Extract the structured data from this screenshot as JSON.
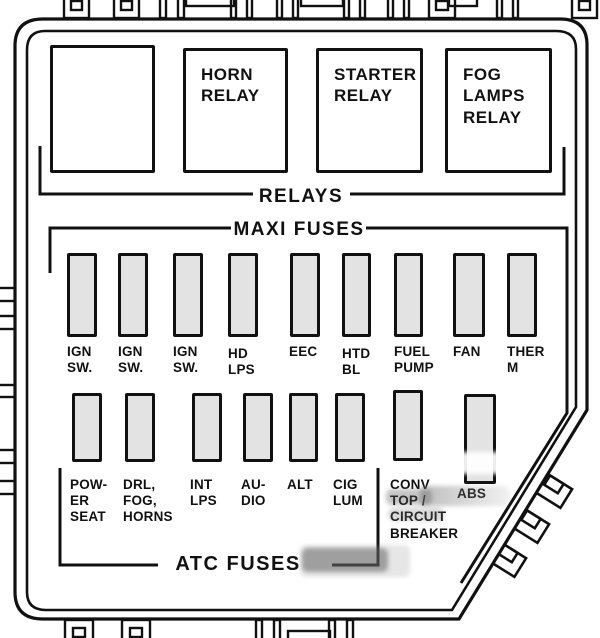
{
  "sections": {
    "relays": {
      "label": "RELAYS",
      "boxes": [
        {
          "label": ""
        },
        {
          "label": "HORN\nRELAY"
        },
        {
          "label": "STARTER\nRELAY"
        },
        {
          "label": "FOG\nLAMPS\nRELAY"
        }
      ]
    },
    "maxi_fuses": {
      "label": "MAXI FUSES",
      "fuses": [
        {
          "label": "IGN\nSW."
        },
        {
          "label": "IGN\nSW."
        },
        {
          "label": "IGN\nSW."
        },
        {
          "label": "HD\nLPS"
        },
        {
          "label": "EEC"
        },
        {
          "label": "HTD\nBL"
        },
        {
          "label": "FUEL\nPUMP"
        },
        {
          "label": "FAN"
        },
        {
          "label": "THER\nM"
        }
      ]
    },
    "atc_fuses": {
      "label": "ATC FUSES",
      "fuses": [
        {
          "label": "POW-\nER\nSEAT"
        },
        {
          "label": "DRL,\nFOG,\nHORNS"
        },
        {
          "label": "INT\nLPS"
        },
        {
          "label": "AU-\nDIO"
        },
        {
          "label": "ALT"
        },
        {
          "label": "CIG\nLUM"
        },
        {
          "label": "CONV\nTOP /\nCIRCUIT\nBREAKER"
        },
        {
          "label": "ABS"
        }
      ]
    }
  },
  "colors": {
    "line": "#111111",
    "fuse_fill": "#e3e3e3",
    "background": "#ffffff"
  }
}
